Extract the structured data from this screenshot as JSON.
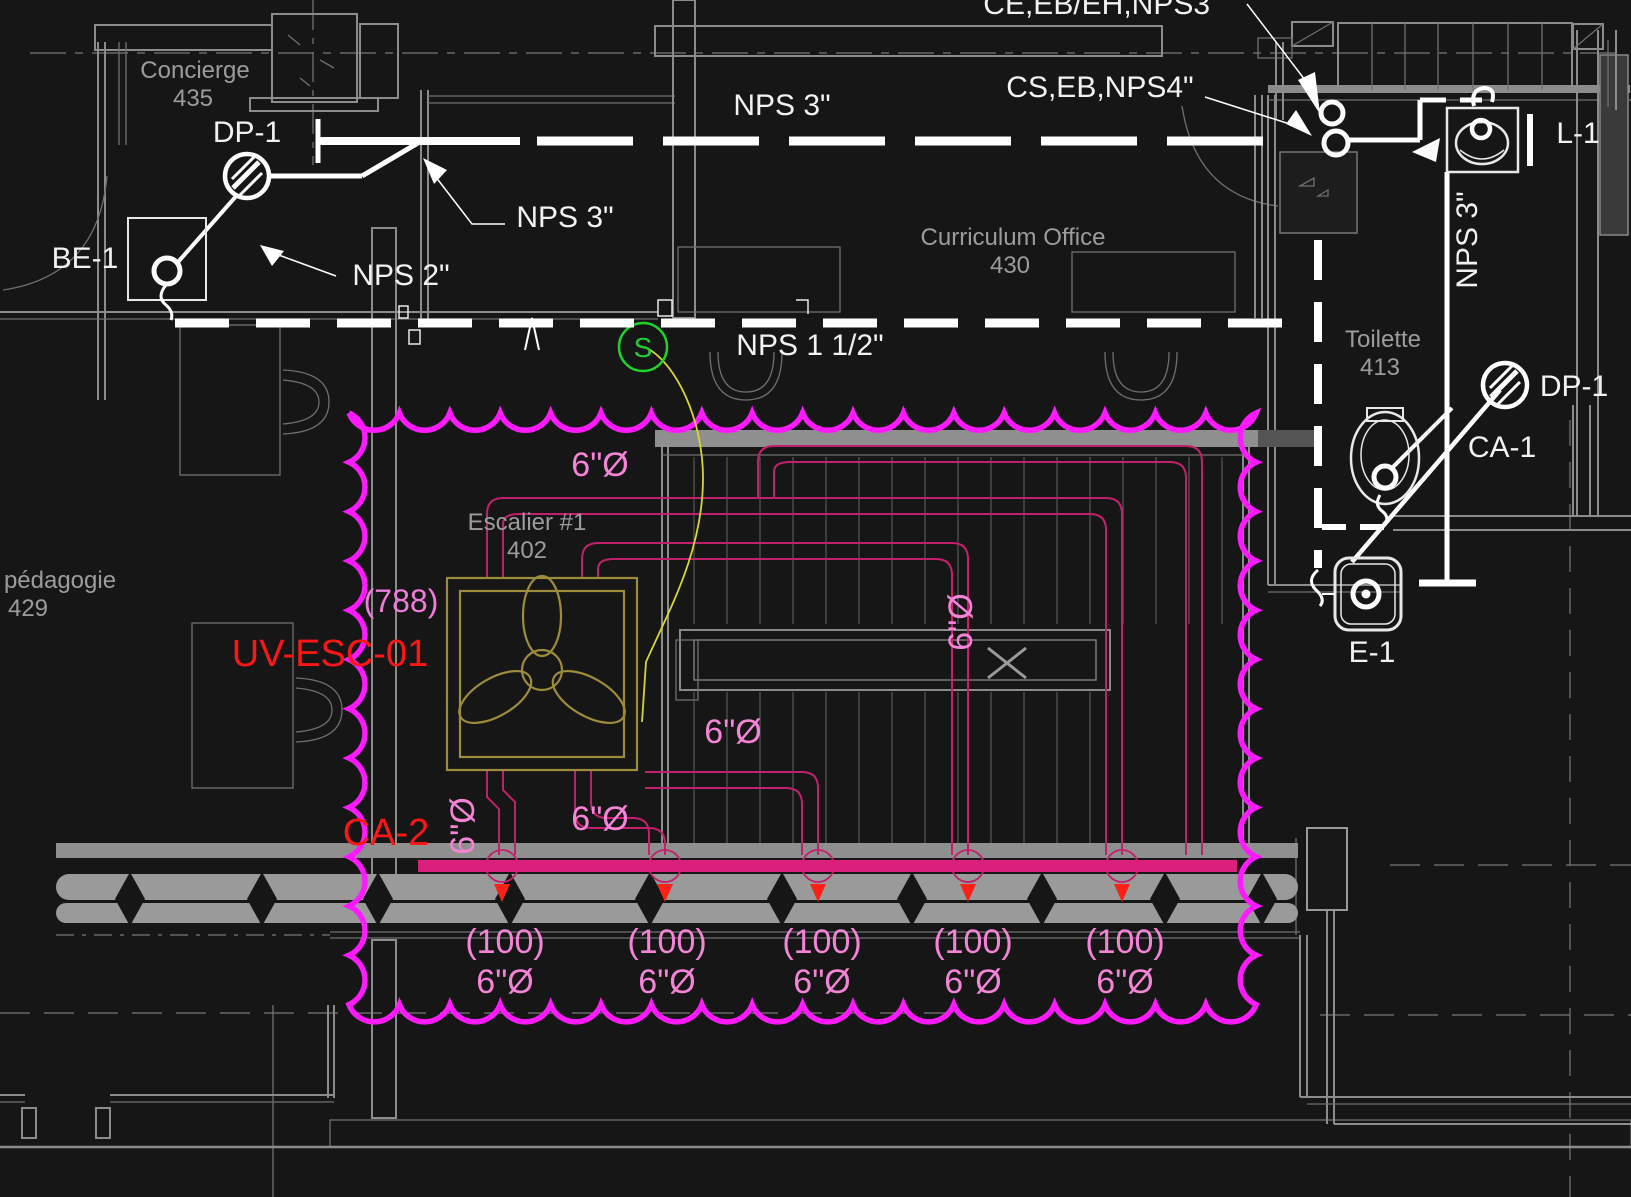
{
  "title": "HVAC/Plumbing floor plan - Escalier #1 sector",
  "colors": {
    "background": "#161616",
    "revision_cloud": "#ff1aff",
    "duct_line": "#c2206d",
    "duct_main": "#da1f7d",
    "pink_label": "#f584d7",
    "red_label": "#ff1515",
    "diffuser_arrow": "#ff2016",
    "fan_symbol": "#9d8c3c",
    "flex_line": "#d8d62c",
    "switch_green": "#22cc33",
    "architecture_gray": "#8c8c8c",
    "room_text": "#9c9c9c",
    "pipe_white": "#ffffff"
  },
  "rooms": {
    "concierge": {
      "name": "Concierge",
      "number": "435"
    },
    "curriculum": {
      "name": "Curriculum Office",
      "number": "430"
    },
    "pedagogie": {
      "name": "pédagogie",
      "number": "429"
    },
    "toilette": {
      "name": "Toilette",
      "number": "413"
    },
    "escalier": {
      "name": "Escalier #1",
      "number": "402"
    }
  },
  "equipment": {
    "dp1_left": "DP-1",
    "be1": "BE-1",
    "dp1_right": "DP-1",
    "ca1": "CA-1",
    "l1": "L-1",
    "e1": "E-1",
    "uv_unit": "UV-ESC-01",
    "ca2": "CA-2",
    "switch": "S"
  },
  "pipes": {
    "nps3_top": "NPS 3\"",
    "nps3_left": "NPS 3\"",
    "nps2": "NPS 2\"",
    "nps1_5": "NPS 1 1/2\"",
    "nps3_vertical": "NPS 3\"",
    "cs_eb_nps4": "CS,EB,NPS4\"",
    "ce_eb_eh_nps3": "CE,EB/EH,NPS3\""
  },
  "ducts": {
    "airflow_788": "(788)",
    "dia_6_a": "6\"Ø",
    "dia_6_b": "6\"Ø",
    "dia_6_c": "6\"Ø",
    "dia_6_vert_left": "6\"Ø",
    "dia_6_vert_stair": "6\"Ø"
  },
  "diffusers": [
    {
      "flow": "(100)",
      "size": "6\"Ø"
    },
    {
      "flow": "(100)",
      "size": "6\"Ø"
    },
    {
      "flow": "(100)",
      "size": "6\"Ø"
    },
    {
      "flow": "(100)",
      "size": "6\"Ø"
    },
    {
      "flow": "(100)",
      "size": "6\"Ø"
    }
  ]
}
